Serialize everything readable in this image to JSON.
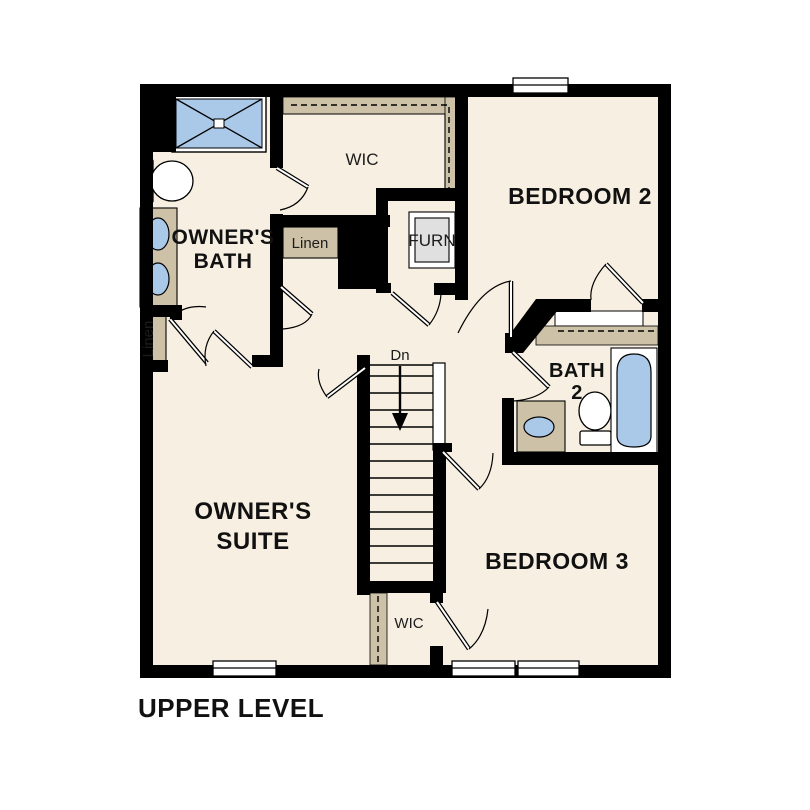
{
  "page": {
    "background": "#ffffff"
  },
  "plan": {
    "level_label": "UPPER LEVEL",
    "colors": {
      "floor": "#f7efe2",
      "wall": "#000000",
      "casework_tan": "#cdc2a8",
      "fixture_blue": "#aac9e8",
      "furnace_gray": "#e0e0e0",
      "window_white": "#ffffff"
    },
    "labels": {
      "owners_bath_line1": "OWNER'S",
      "owners_bath_line2": "BATH",
      "owners_suite_line1": "OWNER'S",
      "owners_suite_line2": "SUITE",
      "bedroom2": "BEDROOM 2",
      "bedroom3": "BEDROOM 3",
      "bath2_line1": "BATH",
      "bath2_line2": "2",
      "wic_upper": "WIC",
      "wic_lower": "WIC",
      "furnace": "FURN",
      "linen_hall": "Linen",
      "linen_owners": "Linen",
      "stairs_direction": "Dn"
    }
  }
}
